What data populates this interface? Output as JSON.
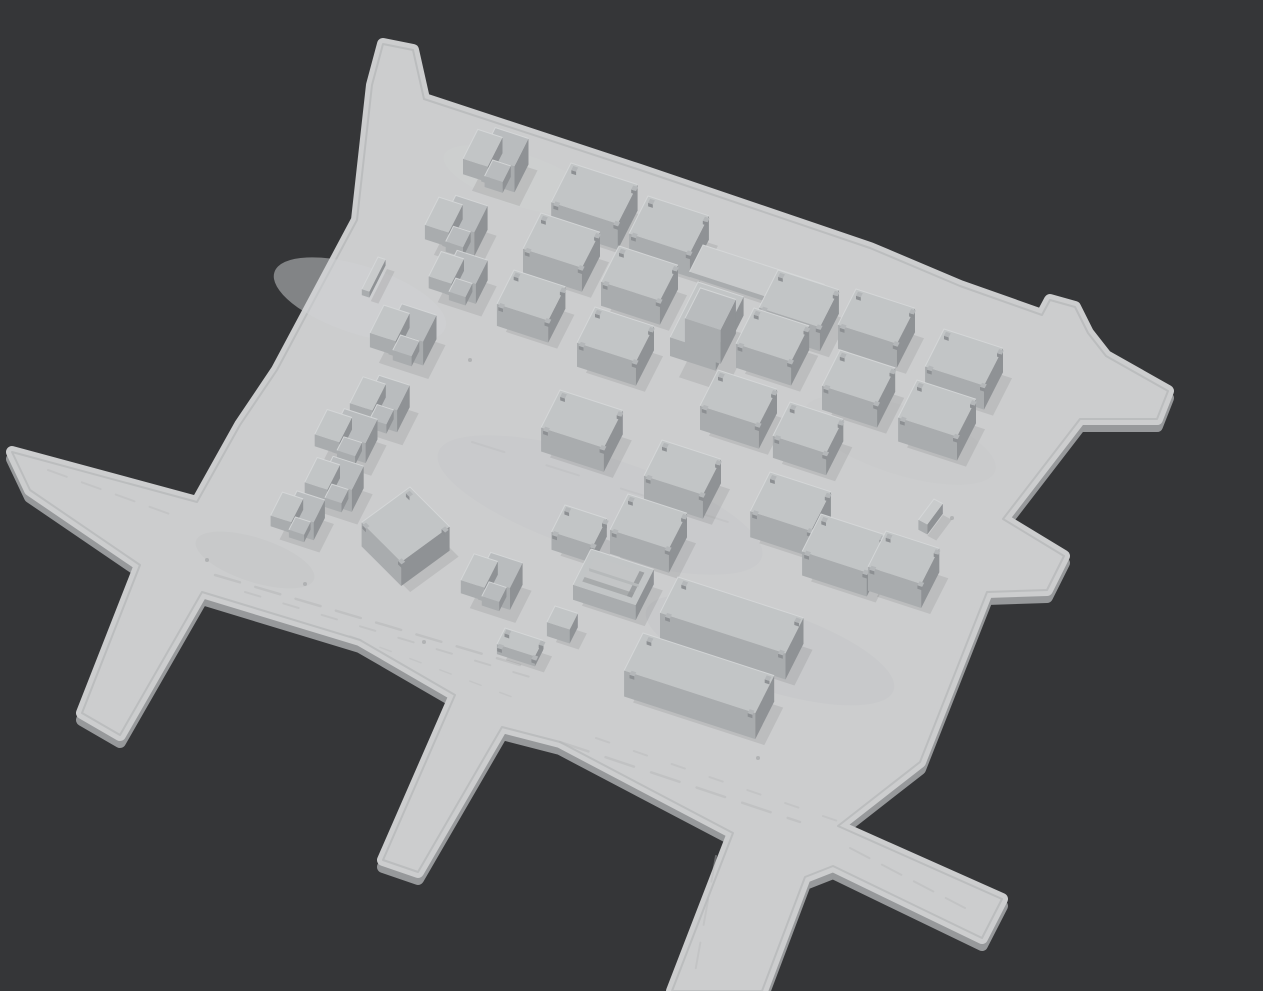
{
  "viewport": {
    "width": 1263,
    "height": 991
  },
  "colors": {
    "background": "#353638",
    "ground": "#cccdce",
    "groundSide": "#97999b",
    "edgeLine": "#b2b4b5",
    "roof": "#c2c5c6",
    "roofAlt": "#b9bcbe",
    "roofEdge": "#d6d8d9",
    "faceFront": "#a9acae",
    "faceSide": "#8f9295",
    "nubTop": "#b4b7b9",
    "nubSide": "#8d9093",
    "padTop": "#c9cbcc",
    "openFloor": "#c3c5c6",
    "openShade": "#96999b",
    "divider": "#b6b9ba",
    "shadow": "rgba(45,47,49,0.10)",
    "streak": "#b7b9ba",
    "dot": "#9fa2a4"
  },
  "axes": {
    "u": [
      0.951,
      0.309
    ],
    "v": [
      -0.451,
      0.892
    ]
  },
  "ground_outline": [
    [
      383,
      44
    ],
    [
      413,
      50
    ],
    [
      424,
      99
    ],
    [
      640,
      170
    ],
    [
      870,
      248
    ],
    [
      960,
      286
    ],
    [
      1042,
      315
    ],
    [
      1050,
      300
    ],
    [
      1075,
      307
    ],
    [
      1088,
      333
    ],
    [
      1106,
      356
    ],
    [
      1168,
      391
    ],
    [
      1157,
      419
    ],
    [
      1080,
      419
    ],
    [
      1003,
      519
    ],
    [
      1064,
      556
    ],
    [
      1047,
      590
    ],
    [
      987,
      592
    ],
    [
      920,
      762
    ],
    [
      838,
      826
    ],
    [
      1002,
      899
    ],
    [
      982,
      938
    ],
    [
      833,
      866
    ],
    [
      805,
      877
    ],
    [
      762,
      991
    ],
    [
      672,
      991
    ],
    [
      733,
      833
    ],
    [
      560,
      742
    ],
    [
      502,
      727
    ],
    [
      418,
      872
    ],
    [
      383,
      860
    ],
    [
      455,
      695
    ],
    [
      360,
      640
    ],
    [
      202,
      592
    ],
    [
      120,
      735
    ],
    [
      82,
      713
    ],
    [
      140,
      565
    ],
    [
      30,
      490
    ],
    [
      12,
      452
    ],
    [
      197,
      502
    ],
    [
      240,
      425
    ],
    [
      277,
      370
    ],
    [
      357,
      220
    ],
    [
      372,
      85
    ]
  ],
  "streaks": [
    {
      "x1": 215,
      "y1": 575,
      "x2": 520,
      "y2": 665,
      "w": 2.5,
      "dash": "26 16",
      "opacity": 0.55
    },
    {
      "x1": 245,
      "y1": 592,
      "x2": 540,
      "y2": 680,
      "w": 2,
      "dash": "16 24",
      "opacity": 0.45
    },
    {
      "x1": 560,
      "y1": 742,
      "x2": 800,
      "y2": 822,
      "w": 2.5,
      "dash": "30 18",
      "opacity": 0.5
    },
    {
      "x1": 596,
      "y1": 738,
      "x2": 852,
      "y2": 826,
      "w": 2,
      "dash": "14 26",
      "opacity": 0.4
    },
    {
      "x1": 850,
      "y1": 848,
      "x2": 965,
      "y2": 908,
      "w": 2,
      "dash": "22 14",
      "opacity": 0.45
    },
    {
      "x1": 48,
      "y1": 470,
      "x2": 175,
      "y2": 516,
      "w": 2,
      "dash": "20 16",
      "opacity": 0.4
    },
    {
      "x1": 472,
      "y1": 442,
      "x2": 888,
      "y2": 572,
      "w": 2,
      "dash": "34 44",
      "opacity": 0.3
    },
    {
      "x1": 716,
      "y1": 856,
      "x2": 694,
      "y2": 978,
      "w": 2,
      "dash": "26 18",
      "opacity": 0.4
    },
    {
      "x1": 350,
      "y1": 636,
      "x2": 520,
      "y2": 700,
      "w": 1.5,
      "dash": "12 20",
      "opacity": 0.35
    }
  ],
  "spots": [
    {
      "cx": 600,
      "cy": 505,
      "rx": 170,
      "ry": 48,
      "fill": "#c6c8c9",
      "opacity": 0.5
    },
    {
      "cx": 770,
      "cy": 650,
      "rx": 130,
      "ry": 40,
      "fill": "#c4c6c7",
      "opacity": 0.45
    },
    {
      "cx": 360,
      "cy": 300,
      "rx": 90,
      "ry": 34,
      "fill": "#d0d2d3",
      "opacity": 0.5
    },
    {
      "cx": 900,
      "cy": 440,
      "rx": 100,
      "ry": 34,
      "fill": "#c7c9ca",
      "opacity": 0.45
    },
    {
      "cx": 255,
      "cy": 560,
      "rx": 62,
      "ry": 22,
      "fill": "#c3c5c6",
      "opacity": 0.5
    },
    {
      "cx": 520,
      "cy": 180,
      "rx": 80,
      "ry": 26,
      "fill": "#d0d2d3",
      "opacity": 0.4
    }
  ],
  "dots": [
    {
      "x": 207,
      "y": 560
    },
    {
      "x": 305,
      "y": 584
    },
    {
      "x": 565,
      "y": 524
    },
    {
      "x": 758,
      "y": 758
    },
    {
      "x": 424,
      "y": 642
    },
    {
      "x": 952,
      "y": 518
    },
    {
      "x": 640,
      "y": 330
    },
    {
      "x": 470,
      "y": 360
    }
  ],
  "buildings": [
    {
      "id": "house-1",
      "kind": "house2",
      "x": 481,
      "y": 123,
      "a": 50,
      "d": 40,
      "h": 26
    },
    {
      "id": "house-2",
      "kind": "house2",
      "x": 442,
      "y": 191,
      "a": 48,
      "d": 38,
      "h": 24
    },
    {
      "id": "house-3",
      "kind": "house2",
      "x": 444,
      "y": 246,
      "a": 46,
      "d": 34,
      "h": 20
    },
    {
      "id": "house-4",
      "kind": "house2",
      "x": 387,
      "y": 299,
      "a": 52,
      "d": 38,
      "h": 24
    },
    {
      "id": "house-5",
      "kind": "house2",
      "x": 366,
      "y": 371,
      "a": 46,
      "d": 36,
      "h": 22
    },
    {
      "id": "house-6",
      "kind": "house2",
      "x": 330,
      "y": 404,
      "a": 50,
      "d": 34,
      "h": 20
    },
    {
      "id": "house-7",
      "kind": "house2",
      "x": 320,
      "y": 452,
      "a": 46,
      "d": 34,
      "h": 22
    },
    {
      "id": "house-8",
      "kind": "house2",
      "x": 285,
      "y": 487,
      "a": 42,
      "d": 32,
      "h": 18
    },
    {
      "id": "wall-a",
      "kind": "pad",
      "x": 378,
      "y": 257,
      "a": 8,
      "d": 36,
      "h": 6
    },
    {
      "id": "box-1",
      "kind": "box",
      "x": 571,
      "y": 163,
      "a": 70,
      "d": 44,
      "h": 26
    },
    {
      "id": "box-2",
      "kind": "box",
      "x": 648,
      "y": 196,
      "a": 64,
      "d": 42,
      "h": 24
    },
    {
      "id": "box-3",
      "kind": "box",
      "x": 541,
      "y": 213,
      "a": 62,
      "d": 40,
      "h": 24
    },
    {
      "id": "box-4",
      "kind": "box",
      "x": 619,
      "y": 246,
      "a": 62,
      "d": 40,
      "h": 24
    },
    {
      "id": "box-5",
      "kind": "box",
      "x": 514,
      "y": 270,
      "a": 54,
      "d": 38,
      "h": 22
    },
    {
      "id": "box-6",
      "kind": "box",
      "x": 595,
      "y": 307,
      "a": 62,
      "d": 40,
      "h": 24
    },
    {
      "id": "tower-1",
      "kind": "tower2",
      "x": 698,
      "y": 282,
      "a": 48,
      "d": 62,
      "h": 34
    },
    {
      "id": "pad-1",
      "kind": "pad",
      "x": 703,
      "y": 245,
      "a": 128,
      "d": 30,
      "h": 5
    },
    {
      "id": "box-7",
      "kind": "box",
      "x": 778,
      "y": 270,
      "a": 64,
      "d": 42,
      "h": 24
    },
    {
      "id": "box-8",
      "kind": "box",
      "x": 856,
      "y": 289,
      "a": 62,
      "d": 40,
      "h": 24
    },
    {
      "id": "box-9",
      "kind": "box",
      "x": 754,
      "y": 308,
      "a": 58,
      "d": 40,
      "h": 24
    },
    {
      "id": "box-10",
      "kind": "box",
      "x": 840,
      "y": 350,
      "a": 58,
      "d": 40,
      "h": 24
    },
    {
      "id": "box-11",
      "kind": "box",
      "x": 718,
      "y": 370,
      "a": 62,
      "d": 40,
      "h": 24
    },
    {
      "id": "box-12",
      "kind": "box",
      "x": 790,
      "y": 402,
      "a": 56,
      "d": 38,
      "h": 22
    },
    {
      "id": "box-13",
      "kind": "box",
      "x": 560,
      "y": 390,
      "a": 66,
      "d": 42,
      "h": 24
    },
    {
      "id": "box-14",
      "kind": "box",
      "x": 662,
      "y": 440,
      "a": 62,
      "d": 40,
      "h": 24
    },
    {
      "id": "box-15",
      "kind": "box",
      "x": 917,
      "y": 380,
      "a": 62,
      "d": 42,
      "h": 24
    },
    {
      "id": "box-16",
      "kind": "box",
      "x": 944,
      "y": 329,
      "a": 62,
      "d": 42,
      "h": 24
    },
    {
      "id": "box-17",
      "kind": "box",
      "x": 770,
      "y": 472,
      "a": 64,
      "d": 44,
      "h": 26
    },
    {
      "id": "box-18",
      "kind": "box",
      "x": 628,
      "y": 494,
      "a": 62,
      "d": 40,
      "h": 24
    },
    {
      "id": "box-19",
      "kind": "box",
      "x": 565,
      "y": 505,
      "a": 44,
      "d": 30,
      "h": 18
    },
    {
      "id": "box-20",
      "kind": "box",
      "x": 821,
      "y": 514,
      "a": 68,
      "d": 42,
      "h": 24
    },
    {
      "id": "box-21",
      "kind": "box",
      "x": 886,
      "y": 531,
      "a": 56,
      "d": 40,
      "h": 24
    },
    {
      "id": "box-rot",
      "kind": "box",
      "x": 410,
      "y": 487,
      "a": 56,
      "d": 60,
      "h": 24,
      "rot": 27
    },
    {
      "id": "house-9",
      "kind": "house2",
      "x": 477,
      "y": 548,
      "a": 48,
      "d": 36,
      "h": 22
    },
    {
      "id": "open-1",
      "kind": "open",
      "x": 591,
      "y": 549,
      "a": 66,
      "d": 40,
      "h": 15
    },
    {
      "id": "shed-1",
      "kind": "box",
      "x": 505,
      "y": 628,
      "a": 40,
      "d": 18,
      "h": 10
    },
    {
      "id": "shed-2",
      "kind": "box",
      "x": 555,
      "y": 606,
      "a": 24,
      "d": 18,
      "h": 14
    },
    {
      "id": "long-1",
      "kind": "box",
      "x": 678,
      "y": 577,
      "a": 132,
      "d": 40,
      "h": 26
    },
    {
      "id": "long-2",
      "kind": "box",
      "x": 643,
      "y": 633,
      "a": 138,
      "d": 42,
      "h": 26
    },
    {
      "id": "post-1",
      "kind": "pad",
      "x": 934,
      "y": 499,
      "a": 10,
      "d": 26,
      "h": 10,
      "rot": 10
    }
  ]
}
